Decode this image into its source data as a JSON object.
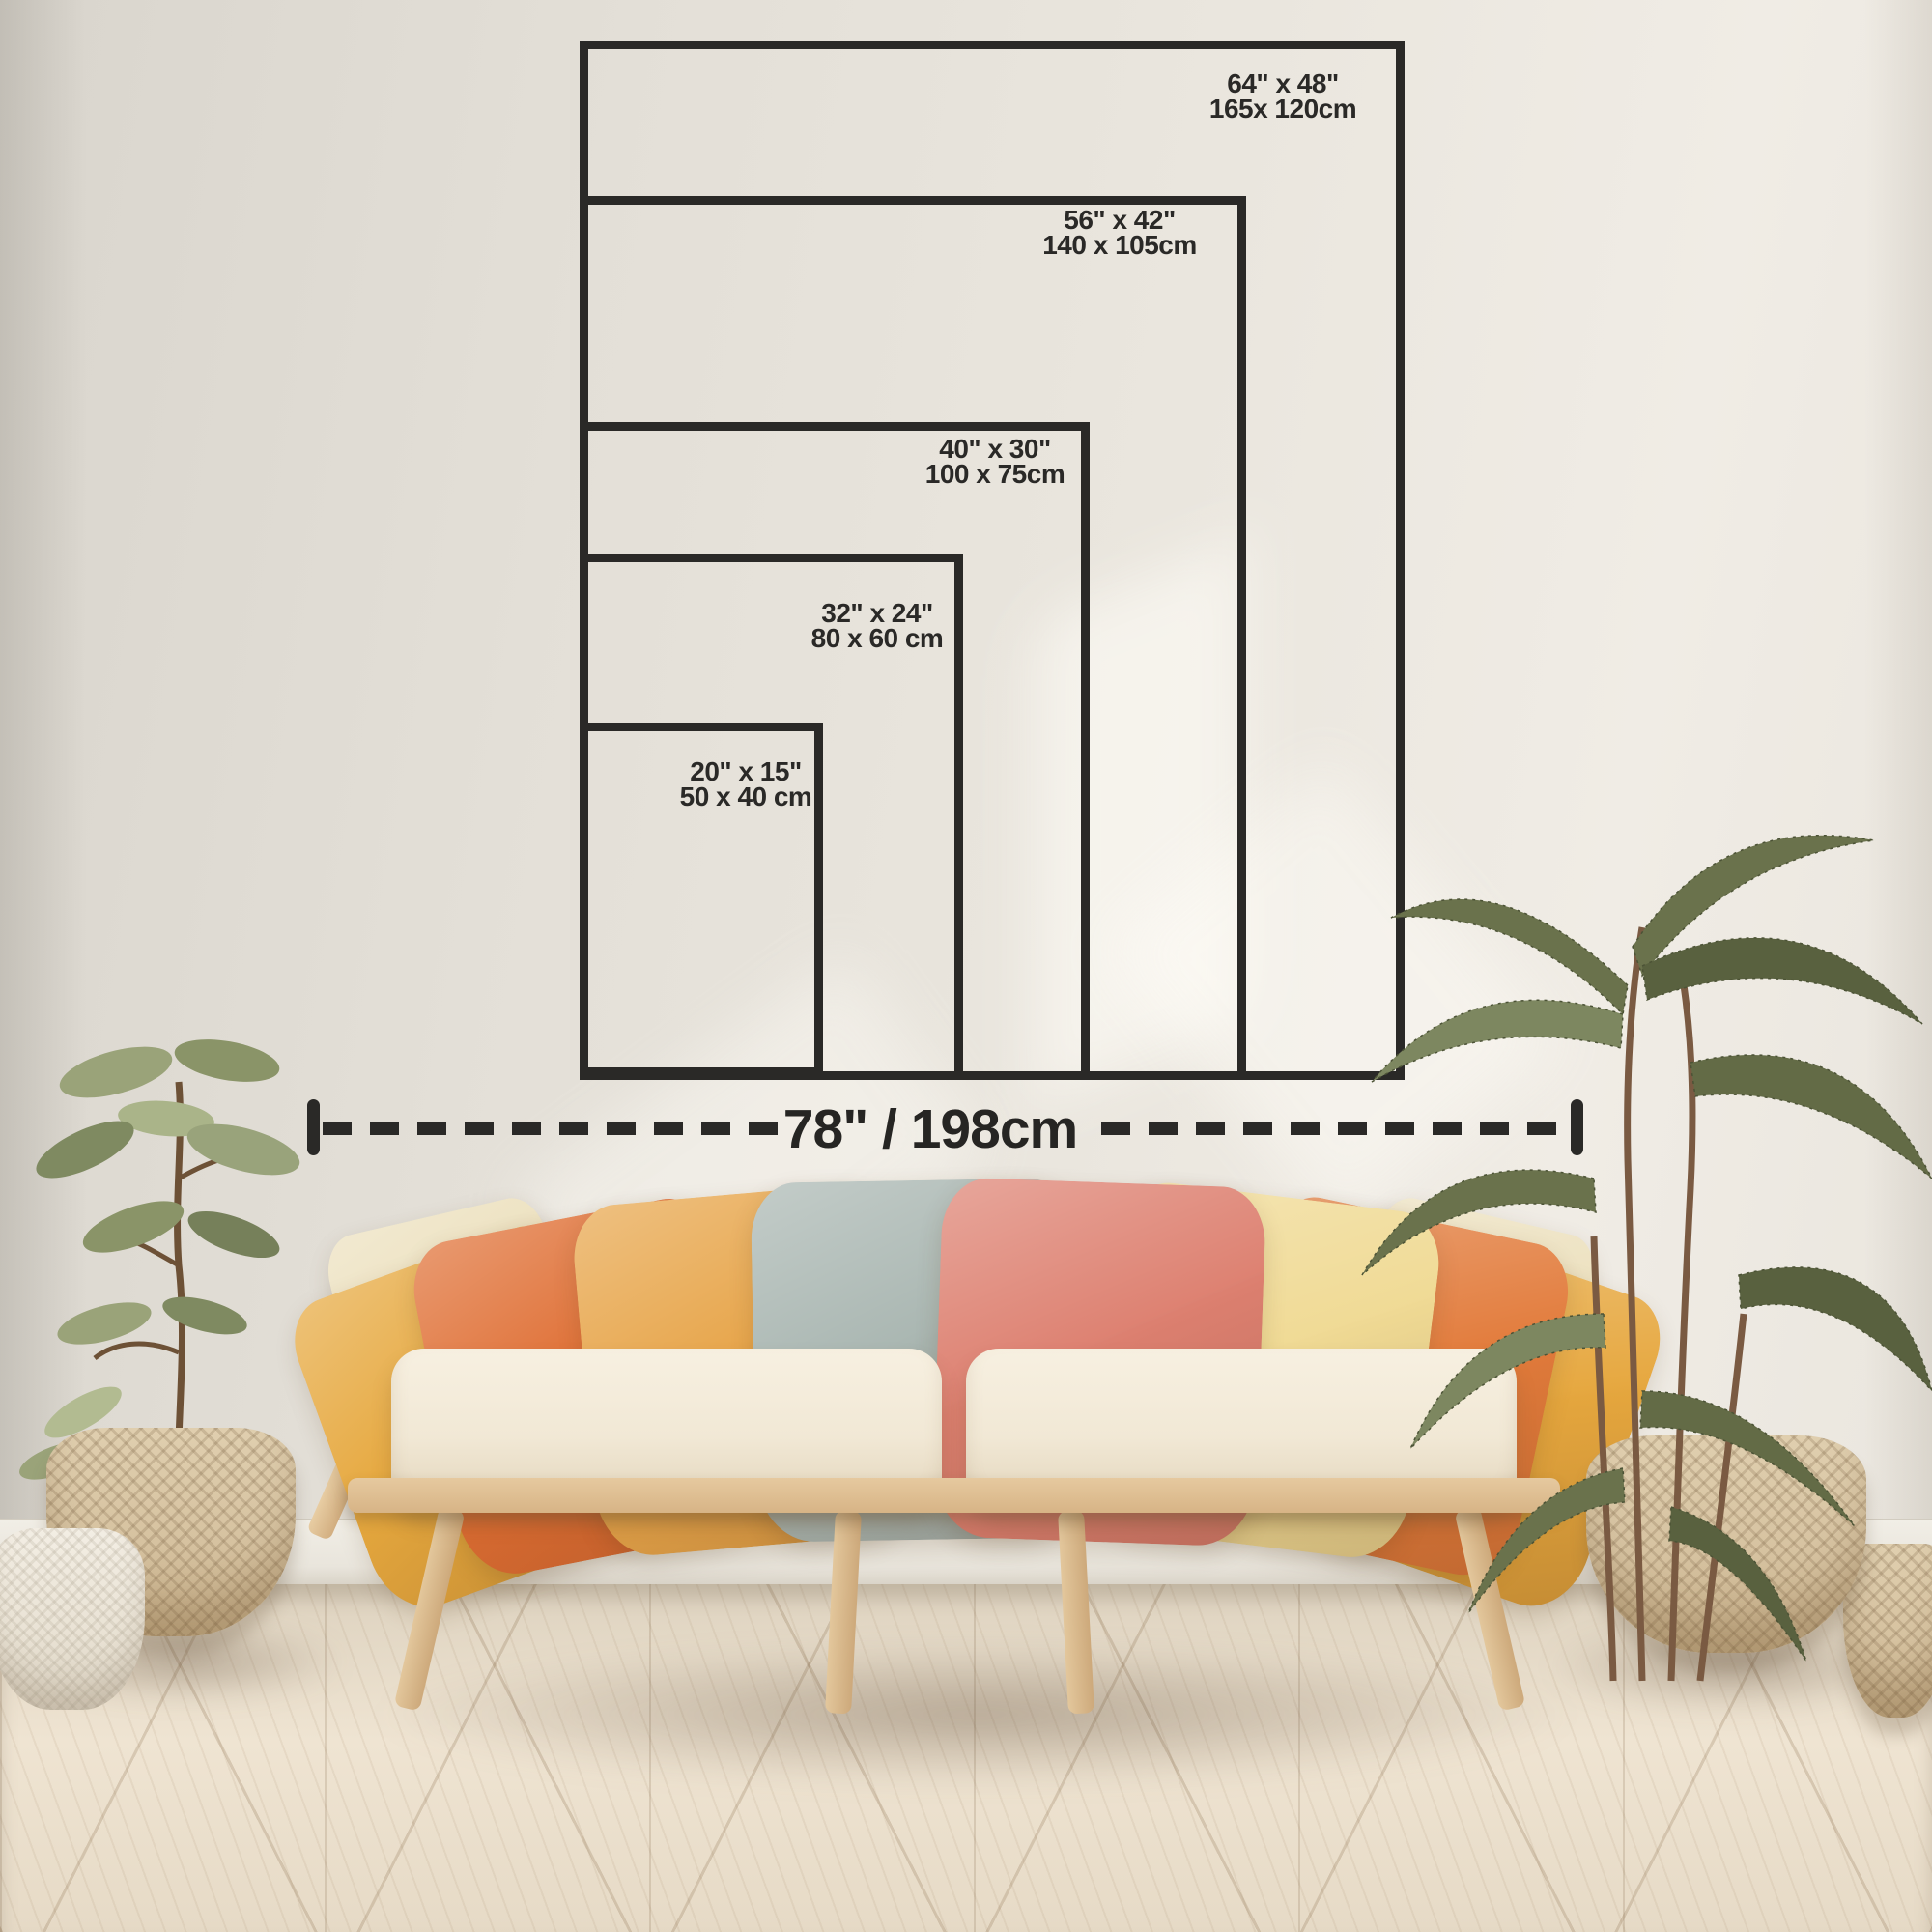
{
  "size_guide": {
    "sizes": [
      {
        "id": "64x48",
        "inches": "64\" x 48\"",
        "cm": "165x 120cm"
      },
      {
        "id": "56x42",
        "inches": "56\" x 42\"",
        "cm": "140 x 105cm"
      },
      {
        "id": "40x30",
        "inches": "40\" x 30\"",
        "cm": "100 x 75cm"
      },
      {
        "id": "32x24",
        "inches": "32\" x 24\"",
        "cm": "80 x 60 cm"
      },
      {
        "id": "20x15",
        "inches": "20\" x 15\"",
        "cm": "50 x 40 cm"
      }
    ],
    "total_width_label": "78\" / 198cm",
    "frame_color": "#2a2927",
    "text_color": "#2a2927"
  },
  "scene": {
    "wall_color": "#e7e3db",
    "floor_color": "#e8ddcb",
    "baseboard_color": "#efece4",
    "sofa": {
      "wood_color": "#ddbf94",
      "cushion_color": "#f4ecdb",
      "pillow_colors": [
        "#e6a83e",
        "#df6e33",
        "#e7a54a",
        "#a9b6b1",
        "#dd8070",
        "#f0da94",
        "#e27b3b",
        "#e6a73e"
      ],
      "back_tip_color": "#ece0bd"
    },
    "plants": {
      "ficus_leaf_green": "#7f8a61",
      "palm_green": "#646b4a",
      "basket_color": "#d9c6a7",
      "white_pot_color": "#efe9dd"
    }
  }
}
